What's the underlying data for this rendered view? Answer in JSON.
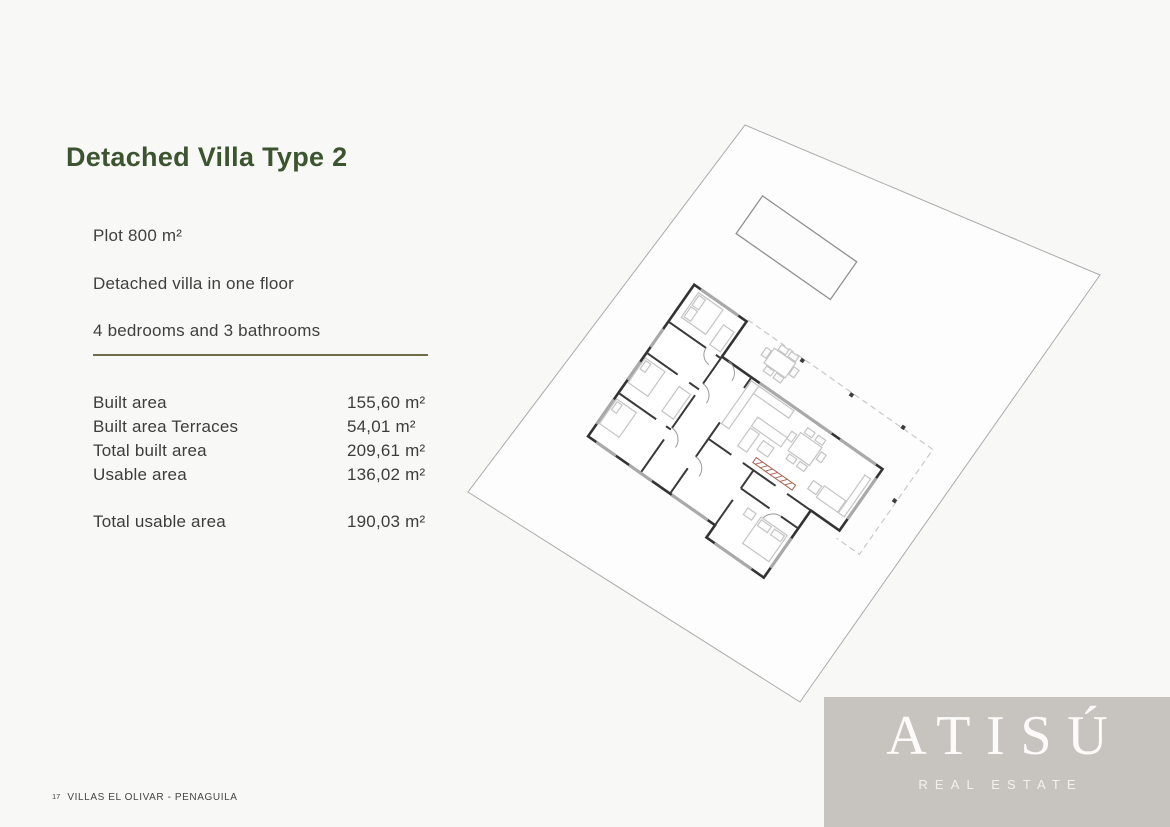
{
  "title": "Detached Villa Type 2",
  "features": [
    "Plot 800 m²",
    "Detached villa in one floor",
    "4 bedrooms and 3 bathrooms"
  ],
  "area_table": {
    "rows": [
      {
        "label": "Built area",
        "value": "155,60 m²"
      },
      {
        "label": "Built area Terraces",
        "value": "54,01 m²"
      },
      {
        "label": "Total built area",
        "value": "209,61 m²"
      },
      {
        "label": "Usable area",
        "value": "136,02 m²"
      }
    ],
    "total": {
      "label": "Total usable area",
      "value": "190,03 m²"
    }
  },
  "footer": {
    "page_number": "17",
    "project_name": "VILLAS EL OLIVAR - PENAGUILA"
  },
  "brand": {
    "name": "ATISÚ",
    "tagline": "REAL ESTATE"
  },
  "floor_plan": {
    "caption": "Rotated site plan showing plot boundary, swimming pool, one-floor villa with 4 bedrooms and 3 bathrooms, and covered terrace with pergola columns",
    "accent_element": "red kitchen counter"
  },
  "colors": {
    "background": "#f8f8f7",
    "title_green": "#3c5530",
    "divider_olive": "#6f6d4c",
    "body_text": "#404040",
    "logo_background": "#c7c4bf",
    "logo_text": "#fcfbf9",
    "plan_walls": "#333333",
    "plan_accent_red": "#a8604e"
  }
}
